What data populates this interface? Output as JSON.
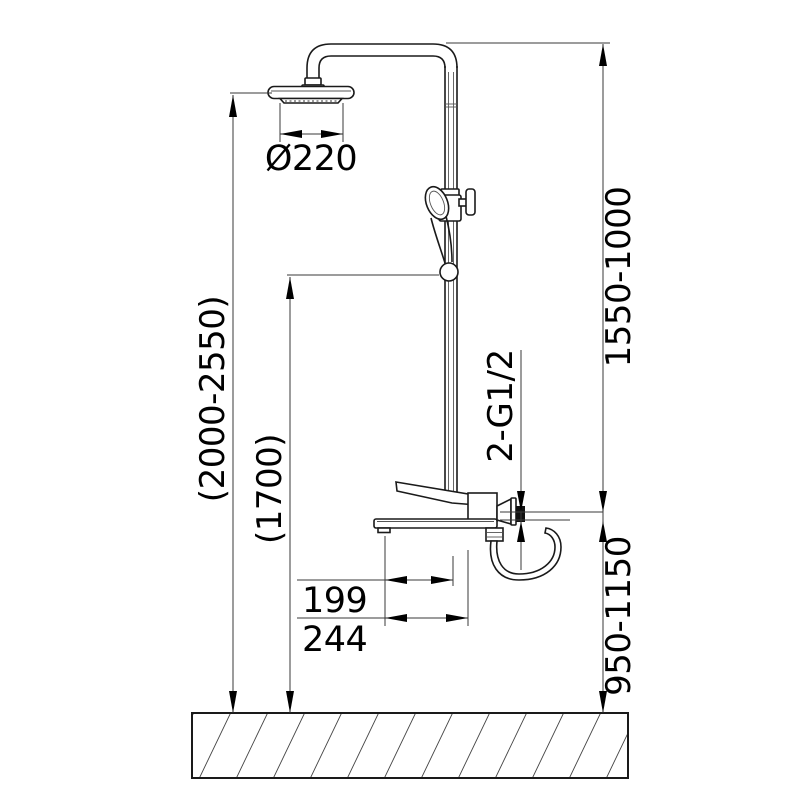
{
  "drawing": {
    "type": "technical-installation-diagram",
    "subject": "shower column with rain head, hand shower and bath mixer",
    "labels": {
      "head_diameter": "Ø220",
      "overall_height_range": "(2000-2550)",
      "hand_shower_height": "(1700)",
      "upper_section_range": "1550-1000",
      "connection_thread": "2-G1/2",
      "spout_reach_inner": "199",
      "spout_reach_outer": "244",
      "lower_section_range": "950-1150"
    },
    "colors": {
      "line": "#1a1a1a",
      "dimension_line": "#3a3a3a",
      "text": "#000000",
      "background": "#ffffff"
    }
  }
}
